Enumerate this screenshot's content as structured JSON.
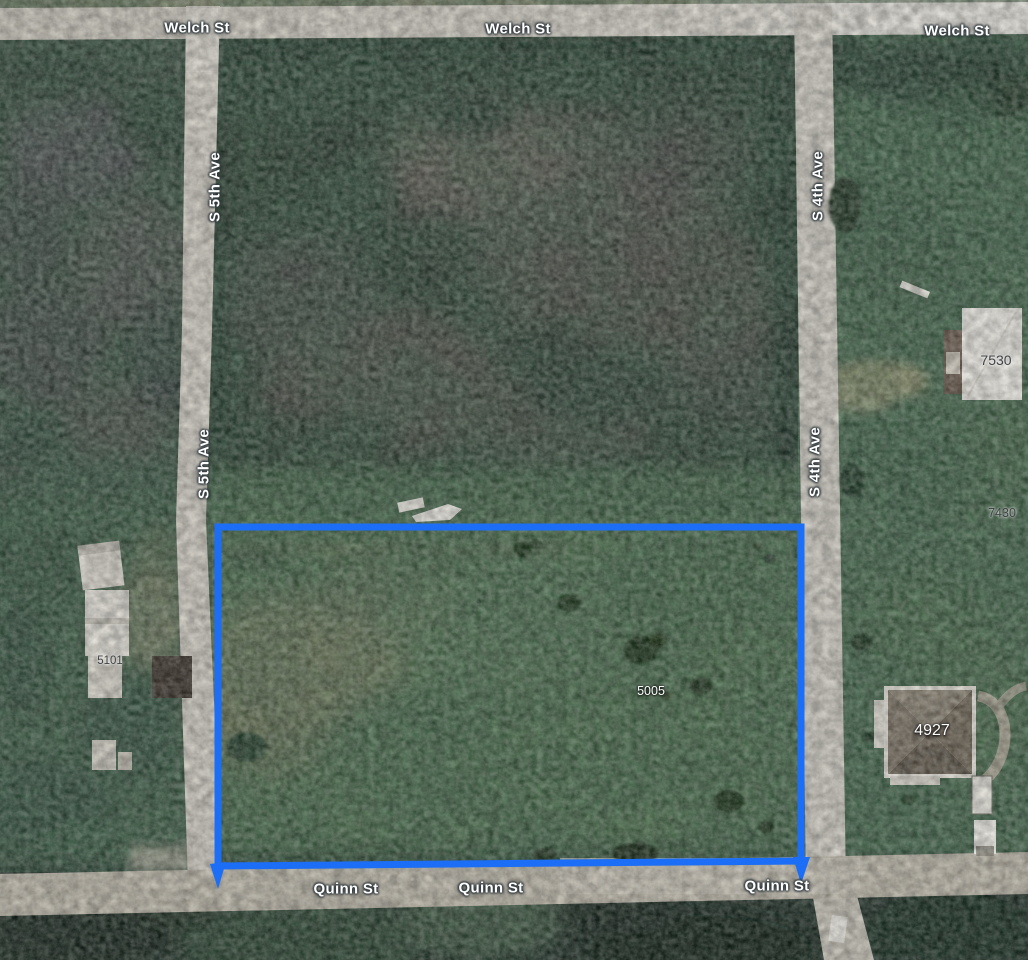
{
  "map": {
    "view_type": "satellite",
    "streets": {
      "welch_st": "Welch St",
      "s_5th_ave": "S 5th Ave",
      "s_4th_ave": "S 4th Ave",
      "quinn_st": "Quinn St"
    },
    "parcels": {
      "highlighted": "5005",
      "left_block": "5101",
      "upper_right": "7530",
      "mid_right": "7430",
      "lower_right": "4927"
    },
    "colors": {
      "parcel_outline_blue": "#1b6ef5",
      "road_gray": "#d0ccc3",
      "field_green": "#507150",
      "forest_dark": "#2d3d33",
      "label_halo": "#323a3e"
    }
  }
}
